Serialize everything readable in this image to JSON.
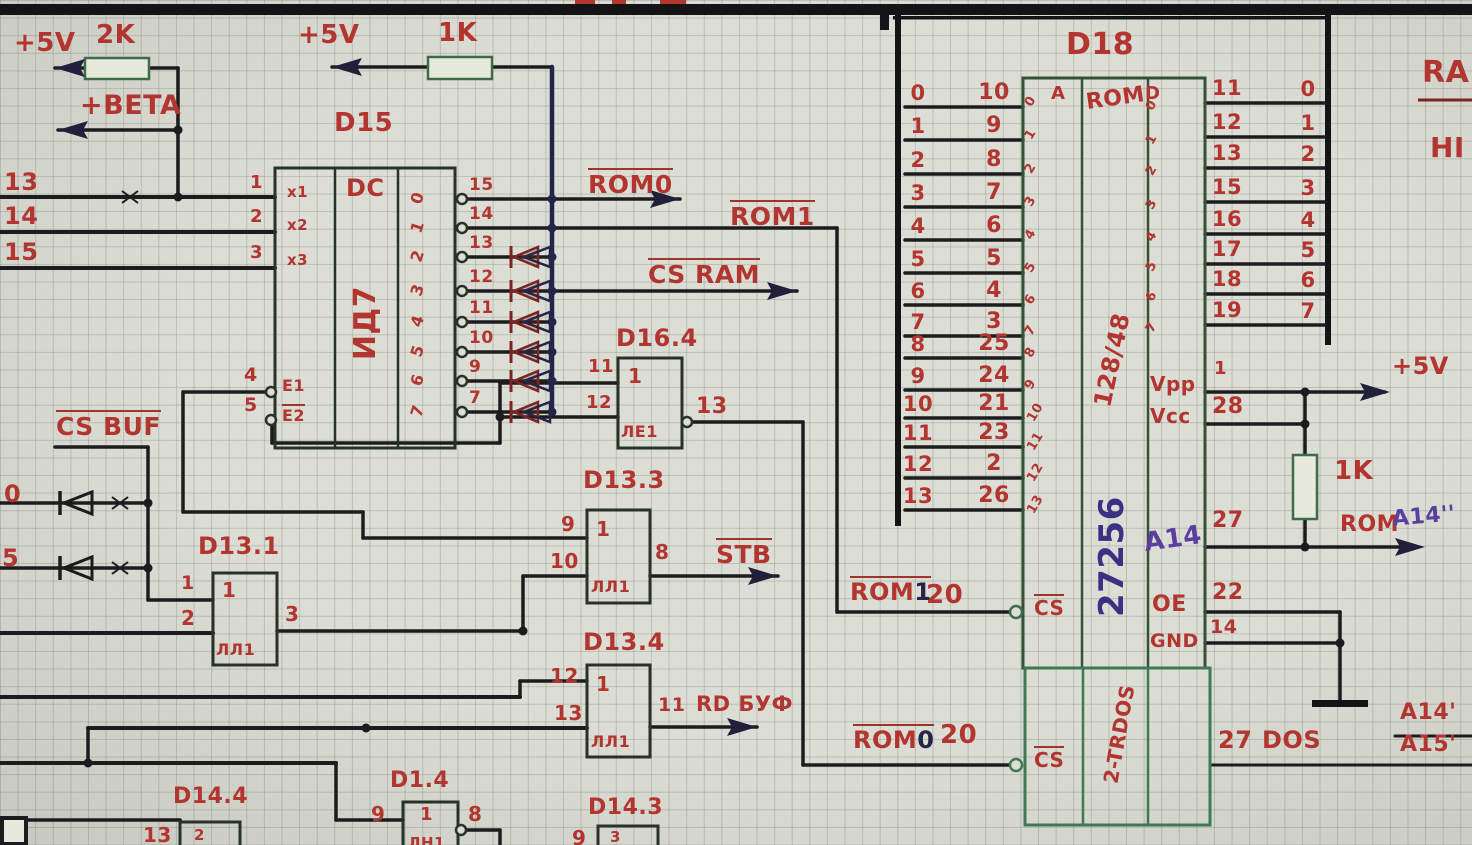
{
  "palette": {
    "red": "#b23530",
    "ink": "#1c1c1f",
    "navy": "#25254a",
    "purple": "#5b3f9e",
    "blue": "#3a3184",
    "green": "#3f6b4a",
    "maroon": "#7c241f",
    "paper": "#dcddd5"
  },
  "power": {
    "plus5v_a": "+5V",
    "r2k": "2K",
    "plus5v_b": "+5V",
    "r1k_top": "1K",
    "beta": "+BETA",
    "plus5v_right": "+5V",
    "r1k_right": "1K"
  },
  "left_bus": {
    "l13": "13",
    "l14": "14",
    "l15": "15",
    "l0": "0",
    "l5": "5"
  },
  "d15": {
    "title": "D15",
    "dc": "DC",
    "part": "ИД7",
    "in_pins": [
      "1",
      "2",
      "3"
    ],
    "in_names": [
      "x1",
      "x2",
      "x3"
    ],
    "en_pins": [
      "4",
      "5"
    ],
    "en_names": [
      "E1",
      "E2"
    ],
    "outputs": [
      {
        "i": "0",
        "pin": "15"
      },
      {
        "i": "1",
        "pin": "14"
      },
      {
        "i": "2",
        "pin": "13"
      },
      {
        "i": "3",
        "pin": "12"
      },
      {
        "i": "4",
        "pin": "11"
      },
      {
        "i": "5",
        "pin": "10"
      },
      {
        "i": "6",
        "pin": "9"
      },
      {
        "i": "7",
        "pin": "7"
      }
    ]
  },
  "signals": {
    "rom0": "ROM0",
    "rom1": "ROM1",
    "csram": "CS RAM",
    "csbuf": "CS BUF",
    "stb": "STB",
    "rdbuf": "RD БУФ"
  },
  "gates": {
    "g164": {
      "title": "D16.4",
      "sym": "1",
      "part": "ЛЕ1",
      "in1": "11",
      "in2": "12",
      "out": "13"
    },
    "g133": {
      "title": "D13.3",
      "sym": "1",
      "part": "ЛЛ1",
      "in1": "9",
      "in2": "10",
      "out": "8"
    },
    "g134": {
      "title": "D13.4",
      "sym": "1",
      "part": "ЛЛ1",
      "in1": "12",
      "in2": "13",
      "out": "11"
    },
    "g131": {
      "title": "D13.1",
      "sym": "1",
      "part": "ЛЛ1",
      "in1": "1",
      "in2": "2",
      "out": "3"
    },
    "g14": {
      "title": "D1.4",
      "sym": "1",
      "part": "ЛН1",
      "in": "9",
      "out": "8"
    },
    "g144": {
      "title": "D14.4",
      "in": "13",
      "sym": "2"
    },
    "g143": {
      "title": "D14.3",
      "in": "9",
      "sym": "3"
    }
  },
  "d18": {
    "title": "D18",
    "col_a": "A",
    "rom": "ROM",
    "col_d": "D",
    "capacity": "128/48",
    "part": "27256",
    "a14_note": "A14",
    "vpp": "Vpp",
    "vcc": "Vcc",
    "p1": "1",
    "p28": "28",
    "p27": "27",
    "rom_lbl": "ROM",
    "a14_q": "A14''",
    "oe": "OE",
    "p22": "22",
    "p14": "14",
    "gnd": "GND",
    "cs": "CS",
    "p20a": "20",
    "p20b": "20",
    "rom1_base": "ROM",
    "rom1_digit": "1",
    "rom0_base": "ROM",
    "rom0_digit": "0",
    "dos_part": "2-TRDOS",
    "p27b": "27",
    "dos": "DOS",
    "addr_rows": [
      {
        "s": "0",
        "p": "10",
        "b": "0"
      },
      {
        "s": "1",
        "p": "9",
        "b": "1"
      },
      {
        "s": "2",
        "p": "8",
        "b": "2"
      },
      {
        "s": "3",
        "p": "7",
        "b": "3"
      },
      {
        "s": "4",
        "p": "6",
        "b": "4"
      },
      {
        "s": "5",
        "p": "5",
        "b": "5"
      },
      {
        "s": "6",
        "p": "4",
        "b": "6"
      },
      {
        "s": "7",
        "p": "3",
        "b": "7"
      },
      {
        "s": "8",
        "p": "25",
        "b": "8"
      },
      {
        "s": "9",
        "p": "24",
        "b": "9"
      },
      {
        "s": "10",
        "p": "21",
        "b": "10"
      },
      {
        "s": "11",
        "p": "23",
        "b": "11"
      },
      {
        "s": "12",
        "p": "2",
        "b": "12"
      },
      {
        "s": "13",
        "p": "26",
        "b": "13"
      }
    ],
    "data_rows": [
      {
        "b": "0",
        "p": "11",
        "s": "0"
      },
      {
        "b": "1",
        "p": "12",
        "s": "1"
      },
      {
        "b": "2",
        "p": "13",
        "s": "2"
      },
      {
        "b": "3",
        "p": "15",
        "s": "3"
      },
      {
        "b": "4",
        "p": "16",
        "s": "4"
      },
      {
        "b": "5",
        "p": "17",
        "s": "5"
      },
      {
        "b": "6",
        "p": "18",
        "s": "6"
      },
      {
        "b": "7",
        "p": "19",
        "s": "7"
      }
    ]
  },
  "corner": {
    "ram": "RA",
    "hi": "HI",
    "a14p": "A14'",
    "a15p": "A15'"
  }
}
